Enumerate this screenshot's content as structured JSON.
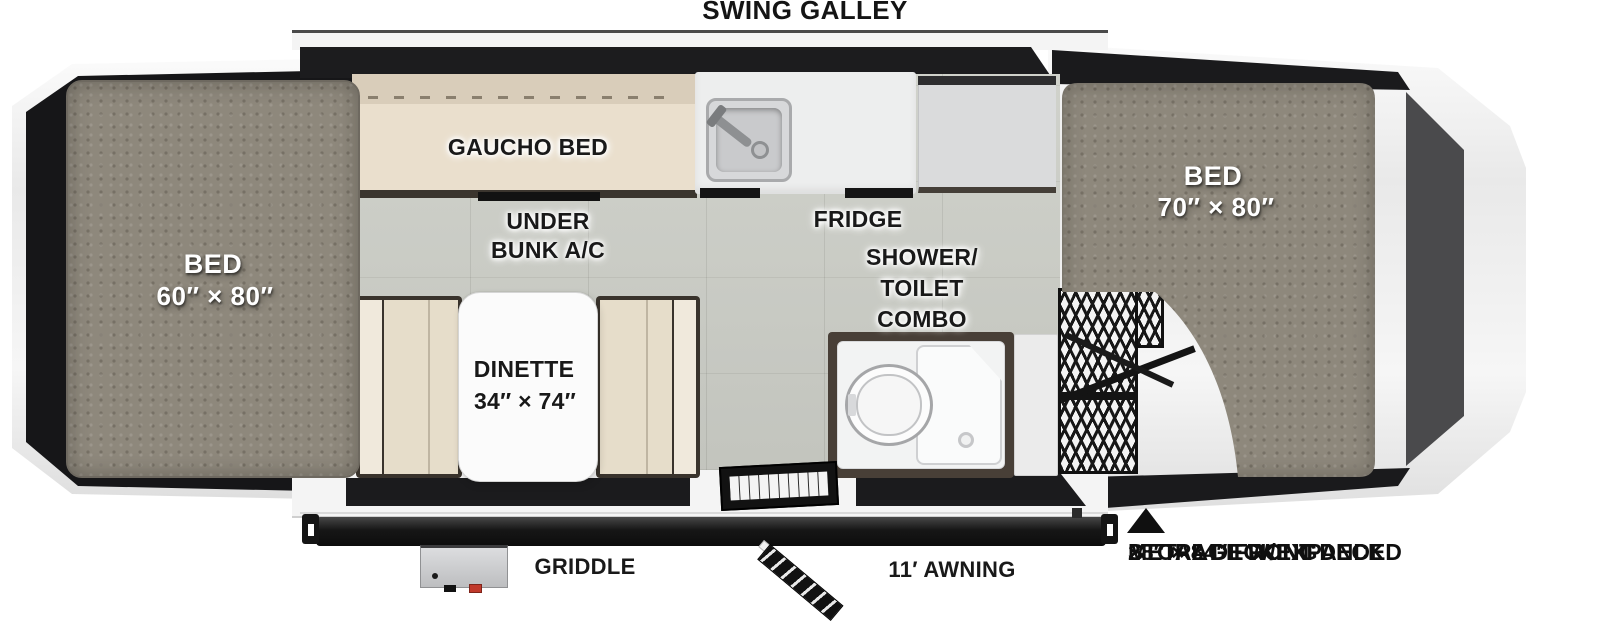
{
  "floorplan": {
    "title": "SWING GALLEY",
    "beds": {
      "left": {
        "name": "BED",
        "size": "60″ × 80″"
      },
      "right": {
        "name": "BED",
        "size": "70″ × 80″"
      }
    },
    "gaucho_bed": "GAUCHO BED",
    "under_bunk_ac": {
      "line1": "UNDER",
      "line2": "BUNK A/C"
    },
    "fridge": "FRIDGE",
    "shower_toilet_combo": {
      "line1": "SHOWER/",
      "line2": "TOILET",
      "line3": "COMBO"
    },
    "dinette": {
      "name": "DINETTE",
      "size": "34″ × 74″"
    },
    "griddle": "GRIDDLE",
    "awning": "11′ AWNING",
    "front_deck_note": {
      "line1": "28″ × 84″ FRONT DECK",
      "line2": "STORAGE W/EXPANDED",
      "line3": "METAL DECKING"
    }
  },
  "colors": {
    "wall_black": "#1b1b1d",
    "trim_white": "#f4f4f4",
    "floor_tile": "#cdcfc8",
    "mattress_gray": "#8e887c",
    "cushion_cream": "#e6ddca",
    "cushion_back": "#d9cdba",
    "counter_white": "#edeeee",
    "fridge_cabinet": "#dadbdc",
    "shower_frame": "#483f37",
    "mesh_black": "#171717",
    "accent_red": "#c0392b",
    "label_black": "#191919",
    "bed_label_white": "#ffffff"
  }
}
